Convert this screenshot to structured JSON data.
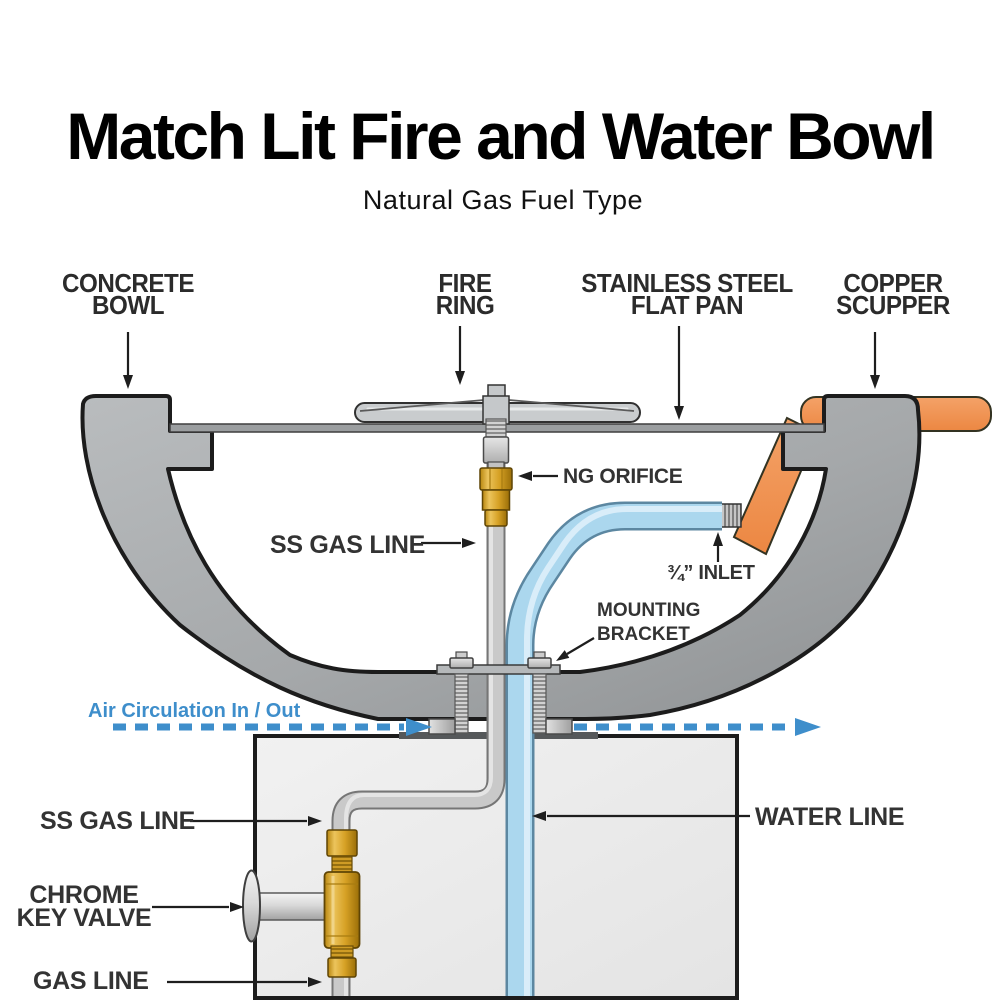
{
  "title": "Match Lit Fire and Water Bowl",
  "subtitle": "Natural Gas Fuel Type",
  "callouts": {
    "concrete_bowl": {
      "line1": "CONCRETE",
      "line2": "BOWL"
    },
    "fire_ring": {
      "line1": "FIRE",
      "line2": "RING"
    },
    "flat_pan": {
      "line1": "STAINLESS STEEL",
      "line2": "FLAT PAN"
    },
    "copper_scupper": {
      "line1": "COPPER",
      "line2": "SCUPPER"
    },
    "ng_orifice": "NG ORIFICE",
    "ss_gas_line_upper": "SS GAS LINE",
    "inlet": "¾” INLET",
    "mounting_bracket": {
      "line1": "MOUNTING",
      "line2": "BRACKET"
    },
    "air_circulation": "Air Circulation In / Out",
    "water_line": "WATER LINE",
    "ss_gas_line_lower": "SS GAS LINE",
    "chrome_key_valve": {
      "line1": "CHROME",
      "line2": "KEY VALVE"
    },
    "gas_line": "GAS LINE"
  },
  "colors": {
    "accent_blue": "#3e8ecb",
    "copper_orange": "#f0955a",
    "water_blue": "#abd7ee",
    "brass_gold": "#d9a72c",
    "bowl_gray": "#a9acae",
    "label_dark": "#2e2e2e"
  }
}
